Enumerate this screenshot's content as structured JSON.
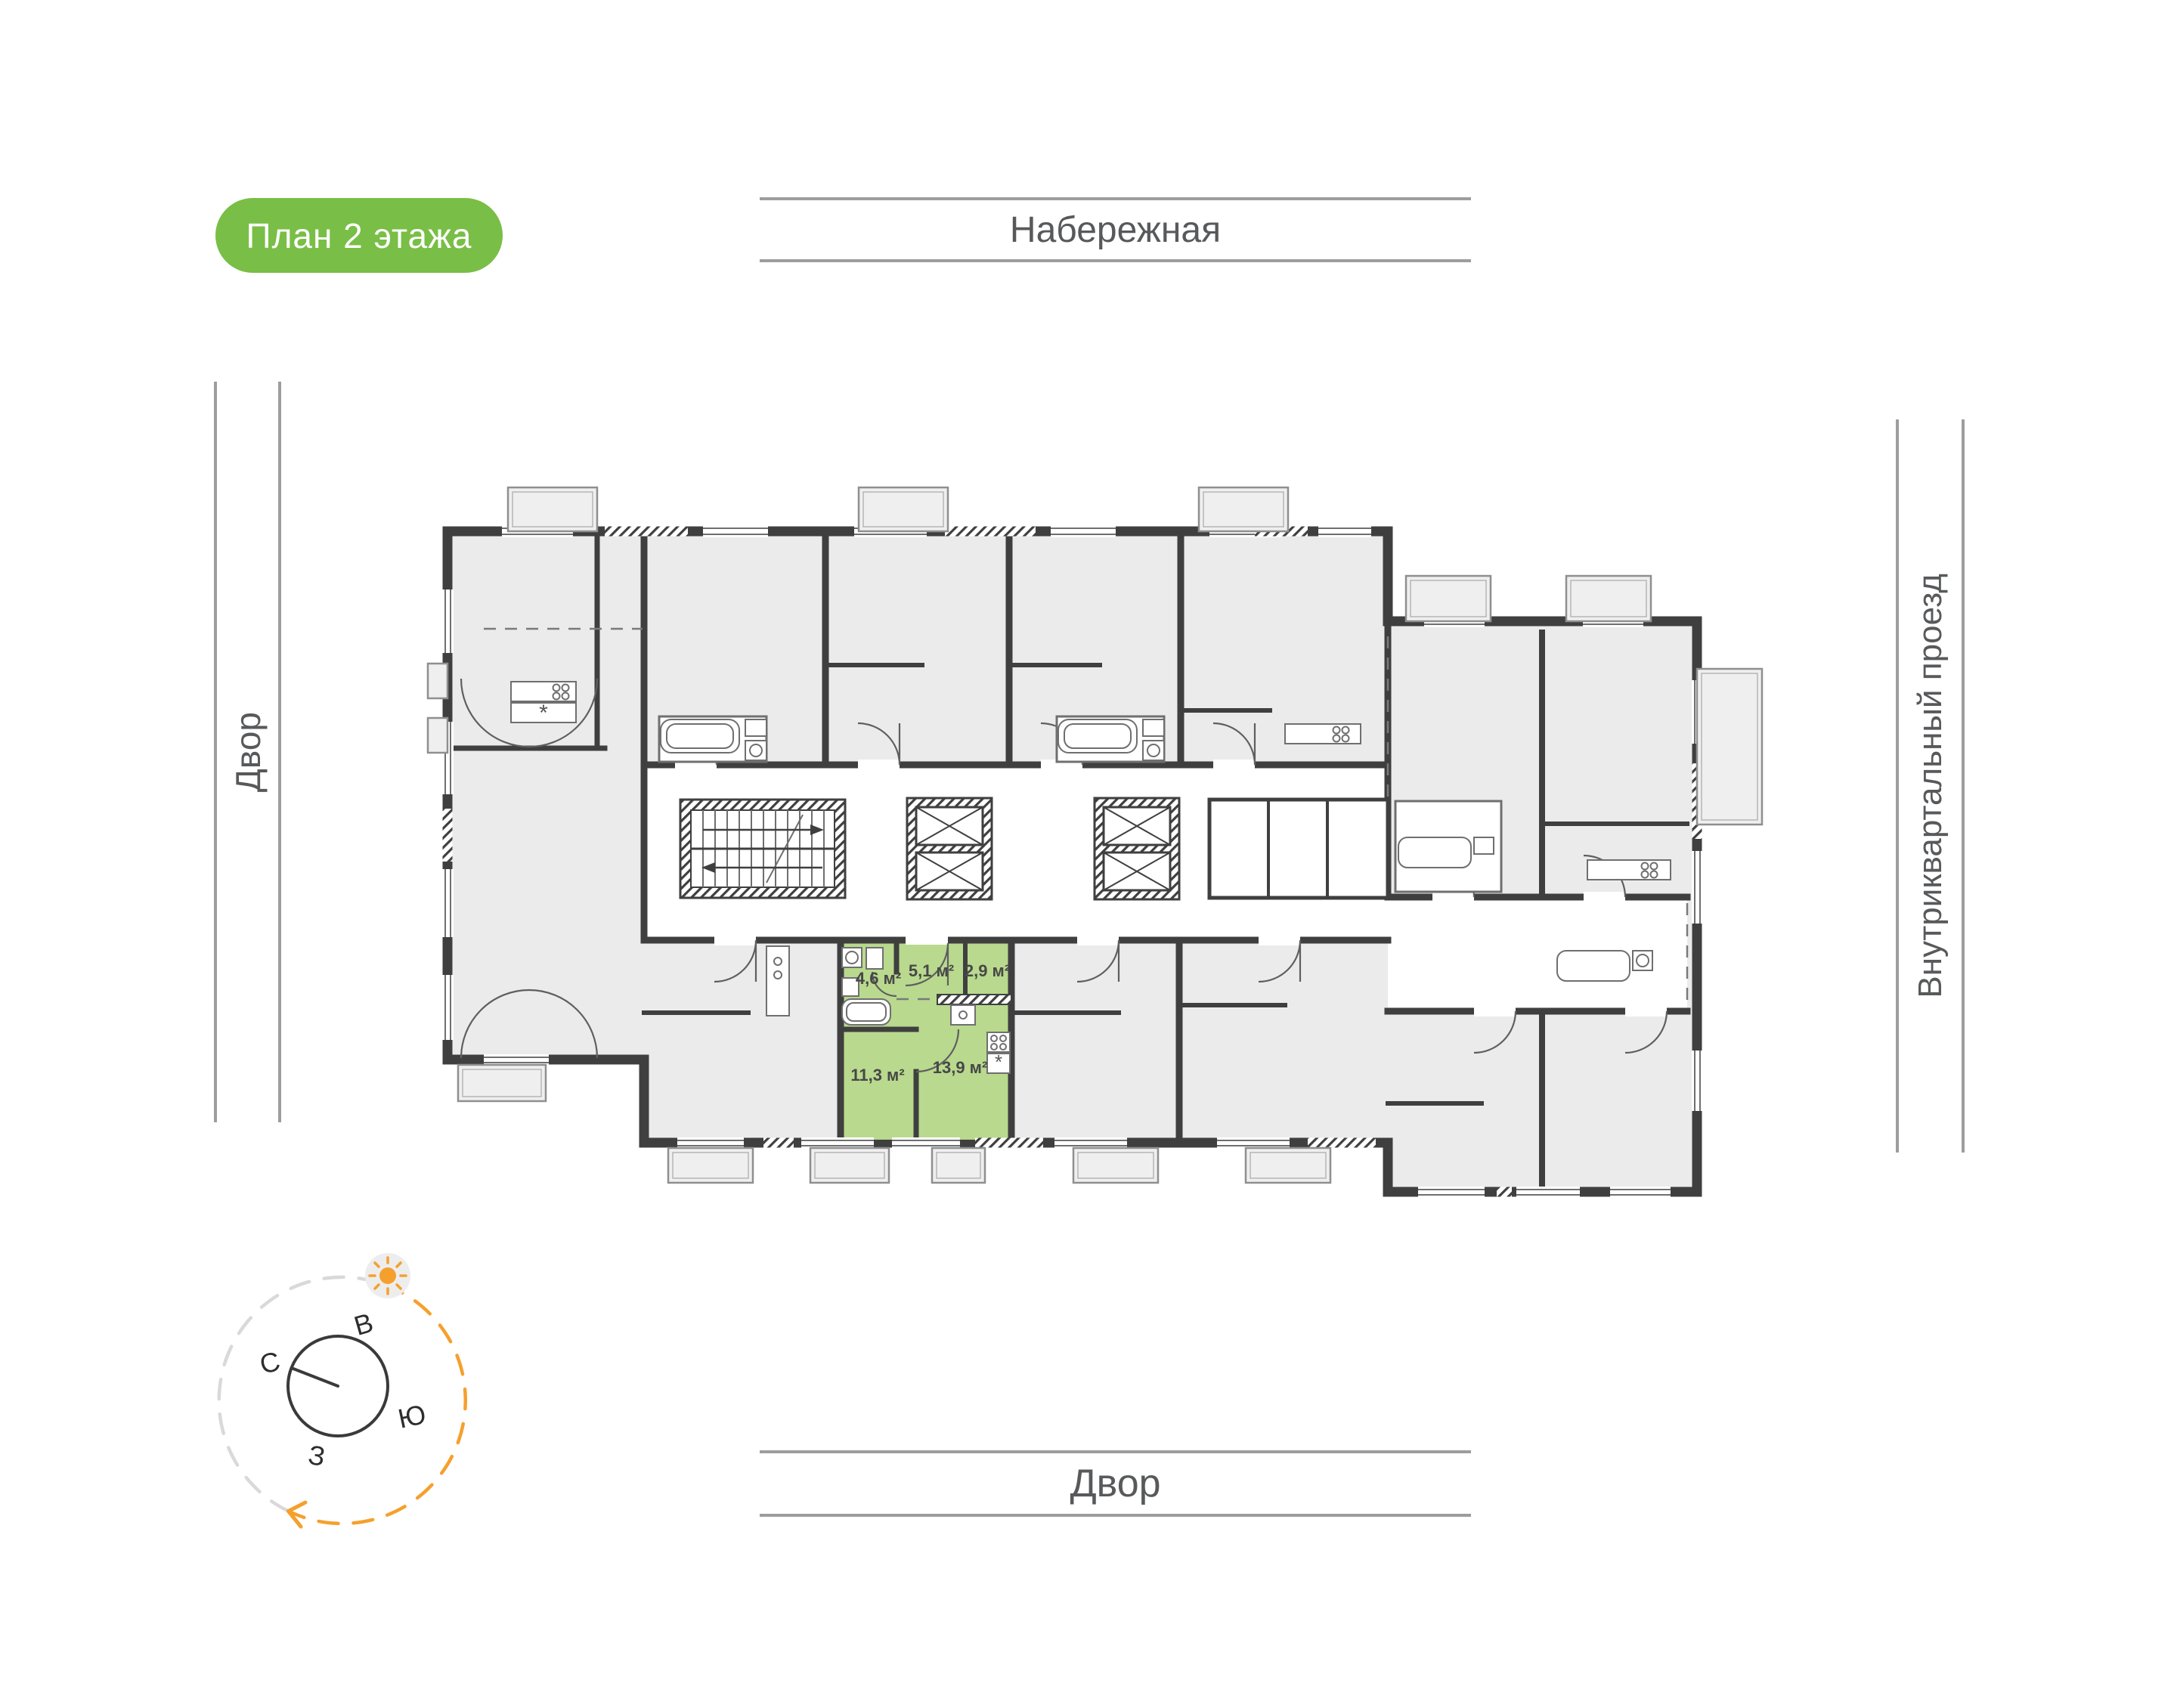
{
  "badge": {
    "label": "План 2 этажа",
    "bg_color": "#79BE46",
    "text_color": "#FFFFFF"
  },
  "streets": {
    "top": {
      "label": "Набережная"
    },
    "left": {
      "label": "Двор"
    },
    "right": {
      "label": "Внутриквартальный проезд"
    },
    "bottom": {
      "label": "Двор"
    }
  },
  "compass": {
    "north": "С",
    "east": "В",
    "south": "Ю",
    "west": "З",
    "orbit_gray_color": "#D9D9D9",
    "orbit_sun_color": "#F5A02D"
  },
  "floor_plan": {
    "colors": {
      "apartment_fill": "#EBEBEB",
      "wall": "#3F3F3F",
      "highlight_fill": "#B9D98E",
      "fixture_line": "#6F6F6F"
    },
    "highlighted_apartment": {
      "rooms": [
        {
          "name": "bathroom",
          "area_label": "4,6 м²"
        },
        {
          "name": "hallway",
          "area_label": "5,1 м²"
        },
        {
          "name": "storage",
          "area_label": "2,9 м²"
        },
        {
          "name": "living-room",
          "area_label": "11,3 м²"
        },
        {
          "name": "kitchen",
          "area_label": "13,9 м²"
        }
      ]
    }
  }
}
